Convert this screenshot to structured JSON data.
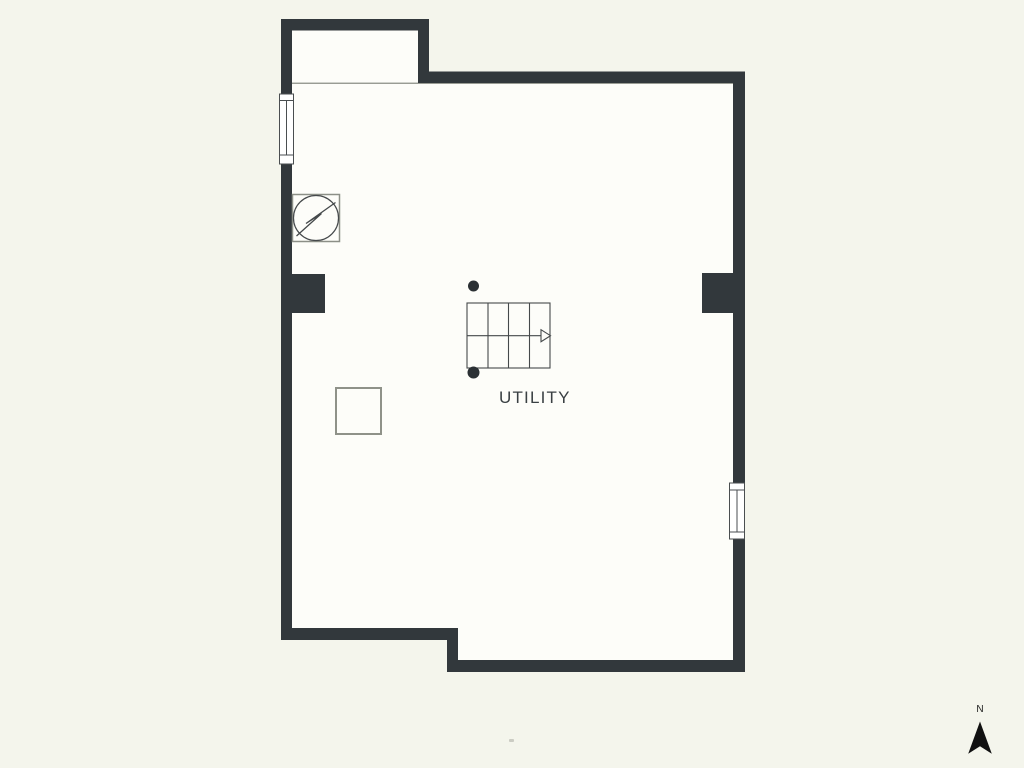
{
  "page": {
    "type": "floor-plan",
    "background_color": "#f4f5ec",
    "floor_fill_color": "#fdfdf9",
    "wall_color": "#32383c",
    "thin_line_color": "#8e9189",
    "symbol_stroke_color": "#45494b",
    "fixture_outline_color": "#8f9289",
    "dot_color": "#2b3034",
    "text_color": "#3a4043"
  },
  "plan": {
    "room_label": "UTILITY",
    "symbols": [
      {
        "name": "staircase",
        "description": "4-tread stair grid with direction arrow pointing right"
      },
      {
        "name": "fan-symbol",
        "description": "circle with zigzag inside a square (mechanical/fan symbol)"
      },
      {
        "name": "square-fixture",
        "description": "small square outline fixture"
      },
      {
        "name": "post-dot-top",
        "description": "small solid round post marker"
      },
      {
        "name": "post-dot-bottom",
        "description": "small solid round post marker"
      },
      {
        "name": "window-left",
        "description": "window symbol in left wall"
      },
      {
        "name": "window-right",
        "description": "window symbol in right wall"
      }
    ]
  },
  "compass": {
    "label": "N",
    "description": "north arrow, bottom right corner"
  }
}
